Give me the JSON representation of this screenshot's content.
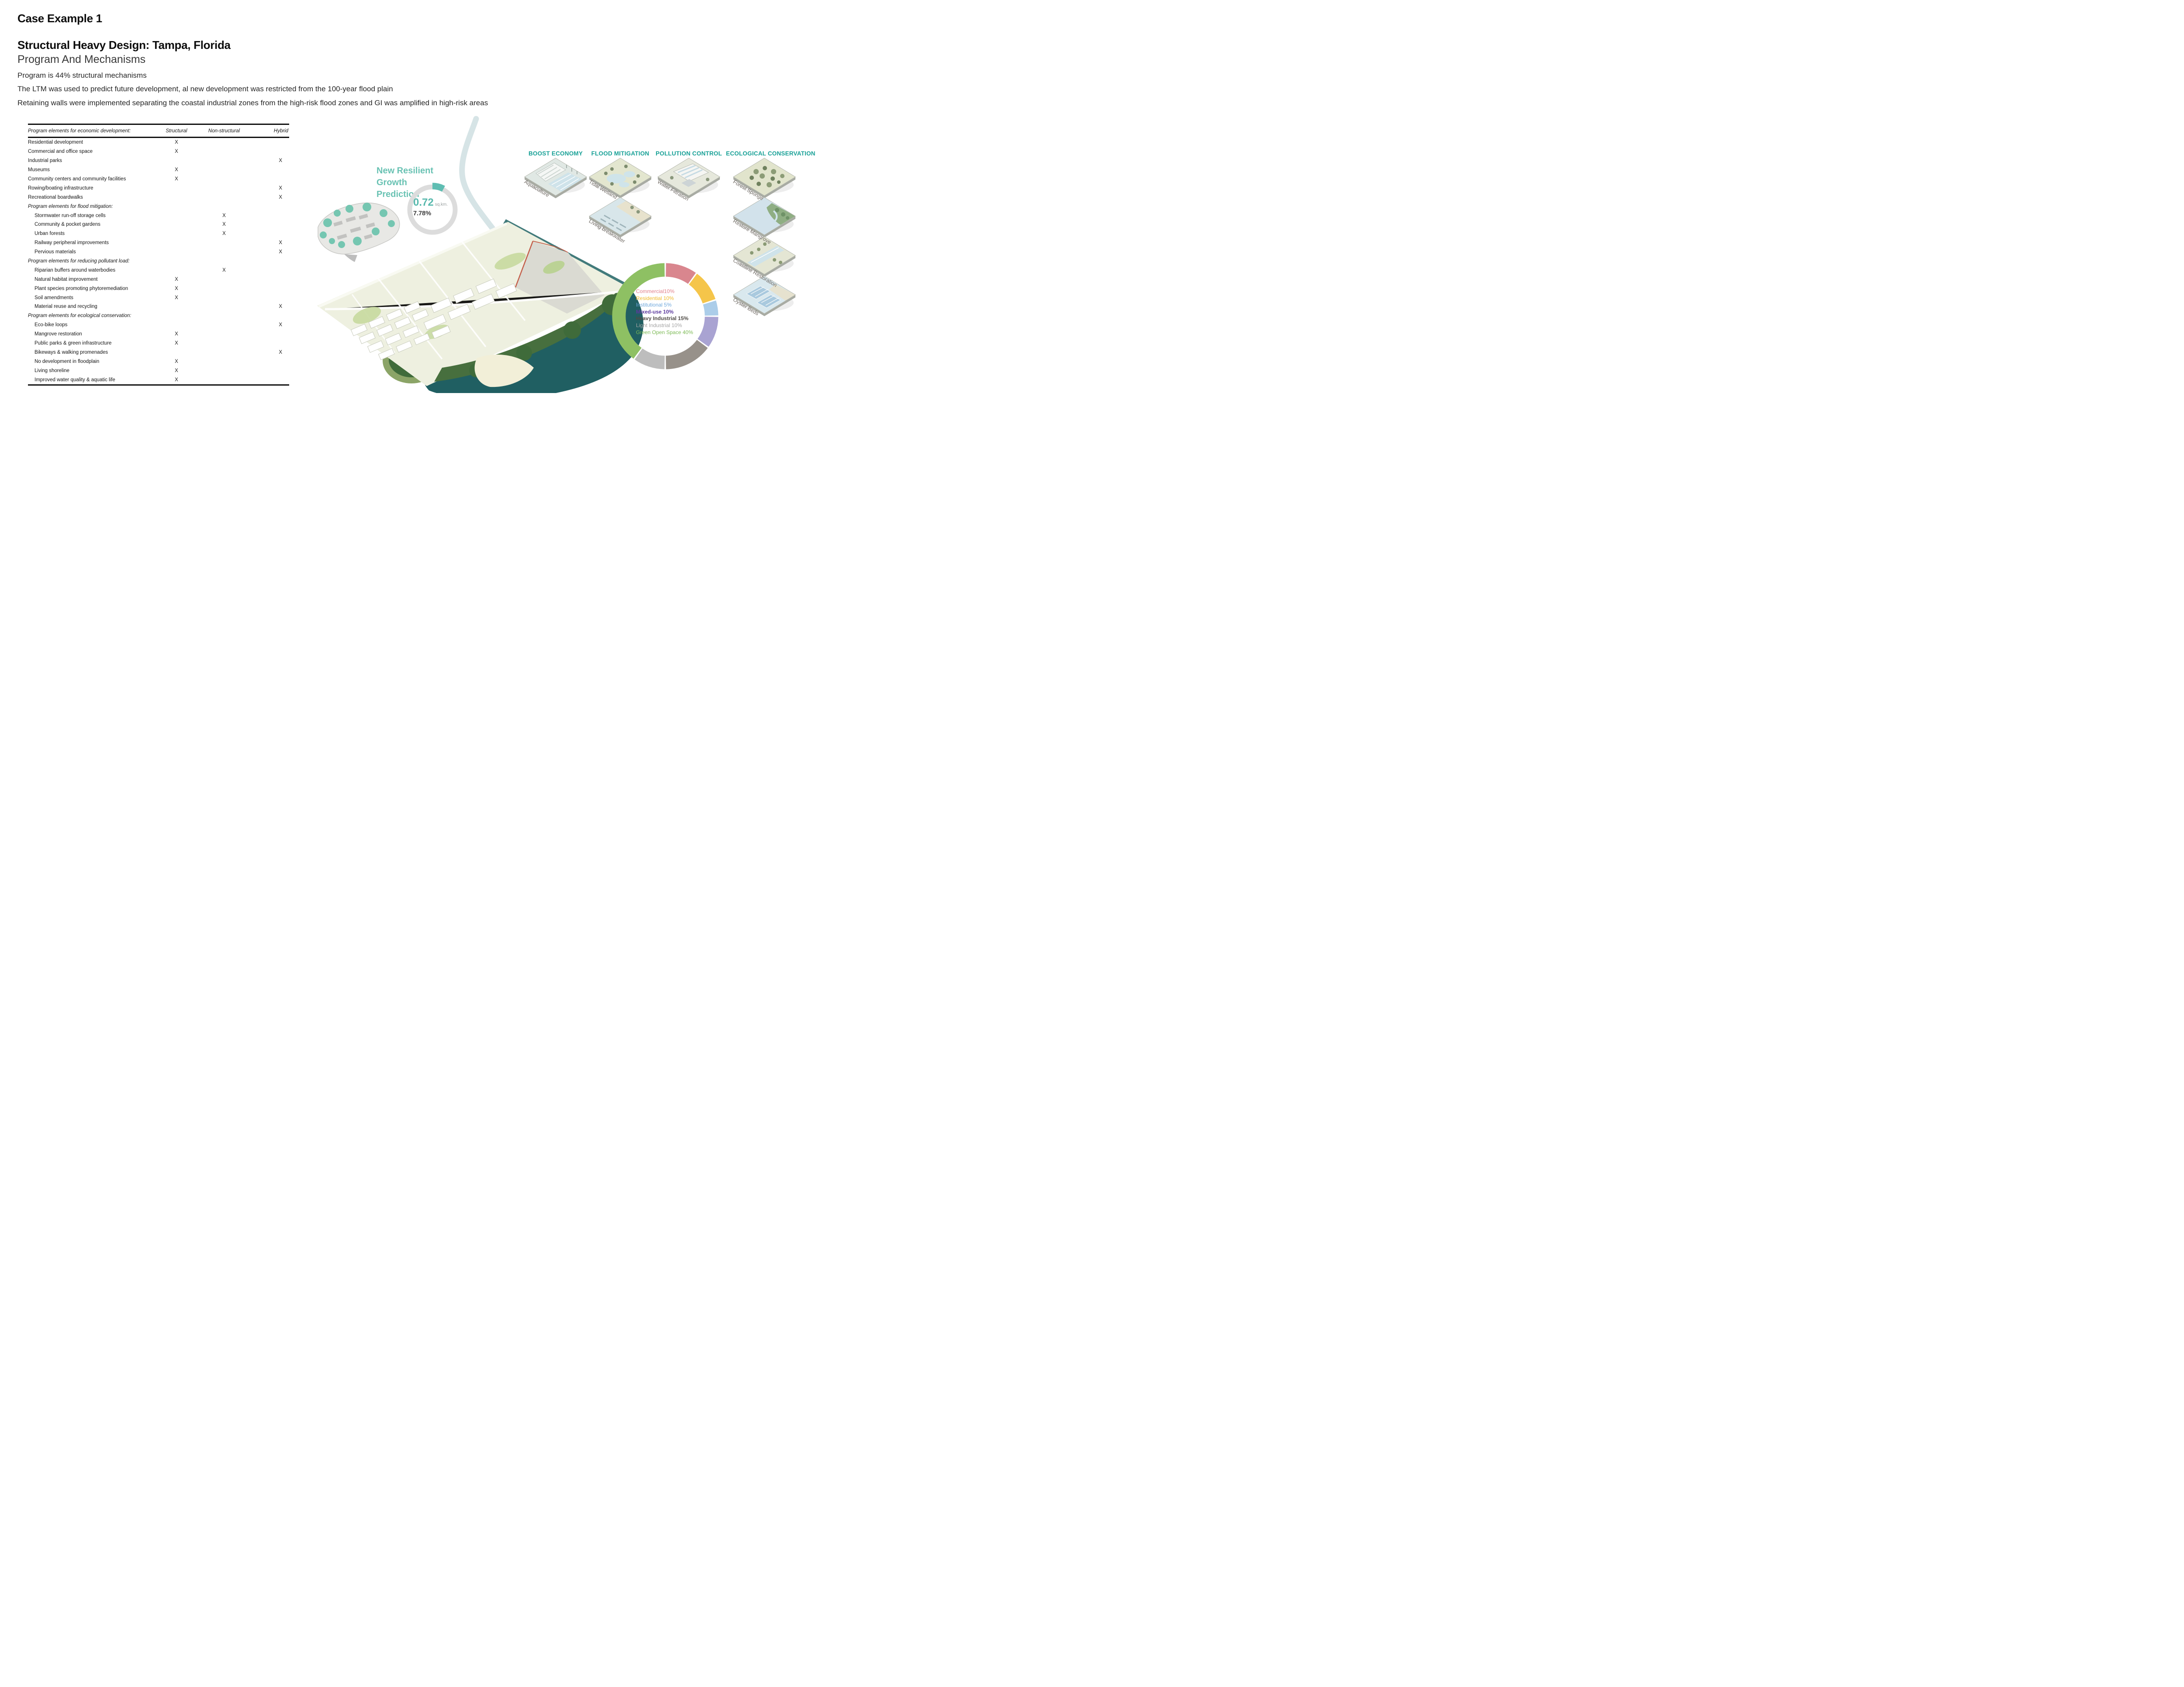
{
  "page": {
    "kicker": "Case Example 1",
    "title": "Structural Heavy Design: Tampa, Florida",
    "subtitle": "Program And Mechanisms",
    "bullets": [
      "Program is 44% structural mechanisms",
      "The LTM was used to predict future development, al new development was restricted from the 100-year flood plain",
      "Retaining walls were implemented separating the coastal industrial zones from the high-risk flood zones and GI was amplified in high-risk areas"
    ]
  },
  "table": {
    "headers": [
      "Program elements for economic development:",
      "Structural",
      "Non-structural",
      "Hybrid"
    ],
    "mark_symbol": "X",
    "rows": [
      {
        "label": "Residential development",
        "mark": "structural",
        "section": false,
        "indent": false
      },
      {
        "label": "Commercial and office space",
        "mark": "structural",
        "section": false,
        "indent": false
      },
      {
        "label": "Industrial parks",
        "mark": "hybrid",
        "section": false,
        "indent": false
      },
      {
        "label": "Museums",
        "mark": "structural",
        "section": false,
        "indent": false
      },
      {
        "label": "Community centers and community facilities",
        "mark": "structural",
        "section": false,
        "indent": false
      },
      {
        "label": "Rowing/boating infrastructure",
        "mark": "hybrid",
        "section": false,
        "indent": false
      },
      {
        "label": "Recreational boardwalks",
        "mark": "hybrid",
        "section": false,
        "indent": false
      },
      {
        "label": "Program elements for flood mitigation:",
        "mark": null,
        "section": true,
        "indent": false
      },
      {
        "label": "Stormwater run-off storage cells",
        "mark": "nonstructural",
        "section": false,
        "indent": true
      },
      {
        "label": "Community & pocket gardens",
        "mark": "nonstructural",
        "section": false,
        "indent": true
      },
      {
        "label": "Urban forests",
        "mark": "nonstructural",
        "section": false,
        "indent": true
      },
      {
        "label": "Railway peripheral improvements",
        "mark": "hybrid",
        "section": false,
        "indent": true
      },
      {
        "label": "Pervious materials",
        "mark": "hybrid",
        "section": false,
        "indent": true
      },
      {
        "label": "Program elements for reducing pollutant load:",
        "mark": null,
        "section": true,
        "indent": false
      },
      {
        "label": "Riparian buffers around waterbodies",
        "mark": "nonstructural",
        "section": false,
        "indent": true
      },
      {
        "label": "Natural habitat improvement",
        "mark": "structural",
        "section": false,
        "indent": true
      },
      {
        "label": "Plant species promoting phytoremediation",
        "mark": "structural",
        "section": false,
        "indent": true
      },
      {
        "label": "Soil amendments",
        "mark": "structural",
        "section": false,
        "indent": true
      },
      {
        "label": "Material reuse and recycling",
        "mark": "hybrid",
        "section": false,
        "indent": true
      },
      {
        "label": "Program elements for ecological conservation:",
        "mark": null,
        "section": true,
        "indent": false
      },
      {
        "label": "Eco-bike loops",
        "mark": "hybrid",
        "section": false,
        "indent": true
      },
      {
        "label": "Mangrove restoration",
        "mark": "structural",
        "section": false,
        "indent": true
      },
      {
        "label": "Public parks & green infrastructure",
        "mark": "structural",
        "section": false,
        "indent": true
      },
      {
        "label": "Bikeways & walking promenades",
        "mark": "hybrid",
        "section": false,
        "indent": true
      },
      {
        "label": "No development in floodplain",
        "mark": "structural",
        "section": false,
        "indent": true
      },
      {
        "label": "Living shoreline",
        "mark": "structural",
        "section": false,
        "indent": true
      },
      {
        "label": "Improved water quality & aquatic life",
        "mark": "structural",
        "section": false,
        "indent": true
      }
    ]
  },
  "prediction": {
    "title_lines": [
      "New Resilient",
      "Growth",
      "Prediction"
    ],
    "value": "0.72",
    "unit": "sq.km.",
    "percent": "7.78%"
  },
  "mechanisms": {
    "columns": [
      {
        "title": "BOOST ECONOMY",
        "tiles": [
          {
            "label": "Aquaculture",
            "motif": "aquaculture"
          }
        ]
      },
      {
        "title": "FLOOD MITIGATION",
        "tiles": [
          {
            "label": "Tidal Wetland",
            "motif": "wetland"
          },
          {
            "label": "Living breakwater",
            "motif": "breakwater"
          }
        ]
      },
      {
        "title": "POLLUTION CONTROL",
        "tiles": [
          {
            "label": "Water Filtration",
            "motif": "filtration"
          }
        ]
      },
      {
        "title": "ECOLOGICAL CONSERVATION",
        "tiles": [
          {
            "label": "Forest Sponge",
            "motif": "forest"
          },
          {
            "label": "Restore Mangrove",
            "motif": "mangrove"
          },
          {
            "label": "Coastline Restoration",
            "motif": "coastline"
          },
          {
            "label": "Oyster Beds",
            "motif": "oyster"
          }
        ]
      }
    ]
  },
  "colors": {
    "heading_teal": "#17a096",
    "pred_title_teal": "#69c2b3",
    "value_teal": "#58b9ad",
    "ring_gray": "#dcdcdc",
    "ring_teal": "#5fbdb2"
  },
  "chart_data": [
    {
      "type": "pie",
      "subtype": "donut",
      "title": "Program land-use mix",
      "legend_position": "center",
      "direction": "clockwise",
      "start_angle_deg": 0,
      "inner_radius_ratio": 0.75,
      "segments": [
        {
          "label": "Commercial",
          "value": 10,
          "display": "Commercial10%",
          "color": "#d9868e",
          "text_color": "#e2808a",
          "bold": false
        },
        {
          "label": "Residential",
          "value": 10,
          "display": "Residential 10%",
          "color": "#f5c54a",
          "text_color": "#f0b929",
          "bold": false
        },
        {
          "label": "Institutional",
          "value": 5,
          "display": "Institutional 5%",
          "color": "#abcde9",
          "text_color": "#6fa8dc",
          "bold": false
        },
        {
          "label": "Mixed-use",
          "value": 10,
          "display": "Mixed-use 10%",
          "color": "#a9a3d2",
          "text_color": "#5c3a9e",
          "bold": true
        },
        {
          "label": "Heavy Industrial",
          "value": 15,
          "display": "Heavy Industrial 15%",
          "color": "#97918a",
          "text_color": "#4f4b46",
          "bold": true
        },
        {
          "label": "Light Industrial",
          "value": 10,
          "display": "Light Industrial 10%",
          "color": "#bdbdbd",
          "text_color": "#a5a5a5",
          "bold": false
        },
        {
          "label": "Green Open Space",
          "value": 40,
          "display": "Green Open Space 40%",
          "color": "#8ec063",
          "text_color": "#7cba54",
          "bold": false
        }
      ]
    },
    {
      "type": "pie",
      "subtype": "donut",
      "title": "New Resilient Growth Prediction",
      "labels": [
        "New resilient growth",
        "Remaining area"
      ],
      "values": [
        7.78,
        92.22
      ],
      "colors": [
        "#5fbdb2",
        "#dcdcdc"
      ],
      "center_label": "0.72 sq.km. 7.78%"
    }
  ]
}
